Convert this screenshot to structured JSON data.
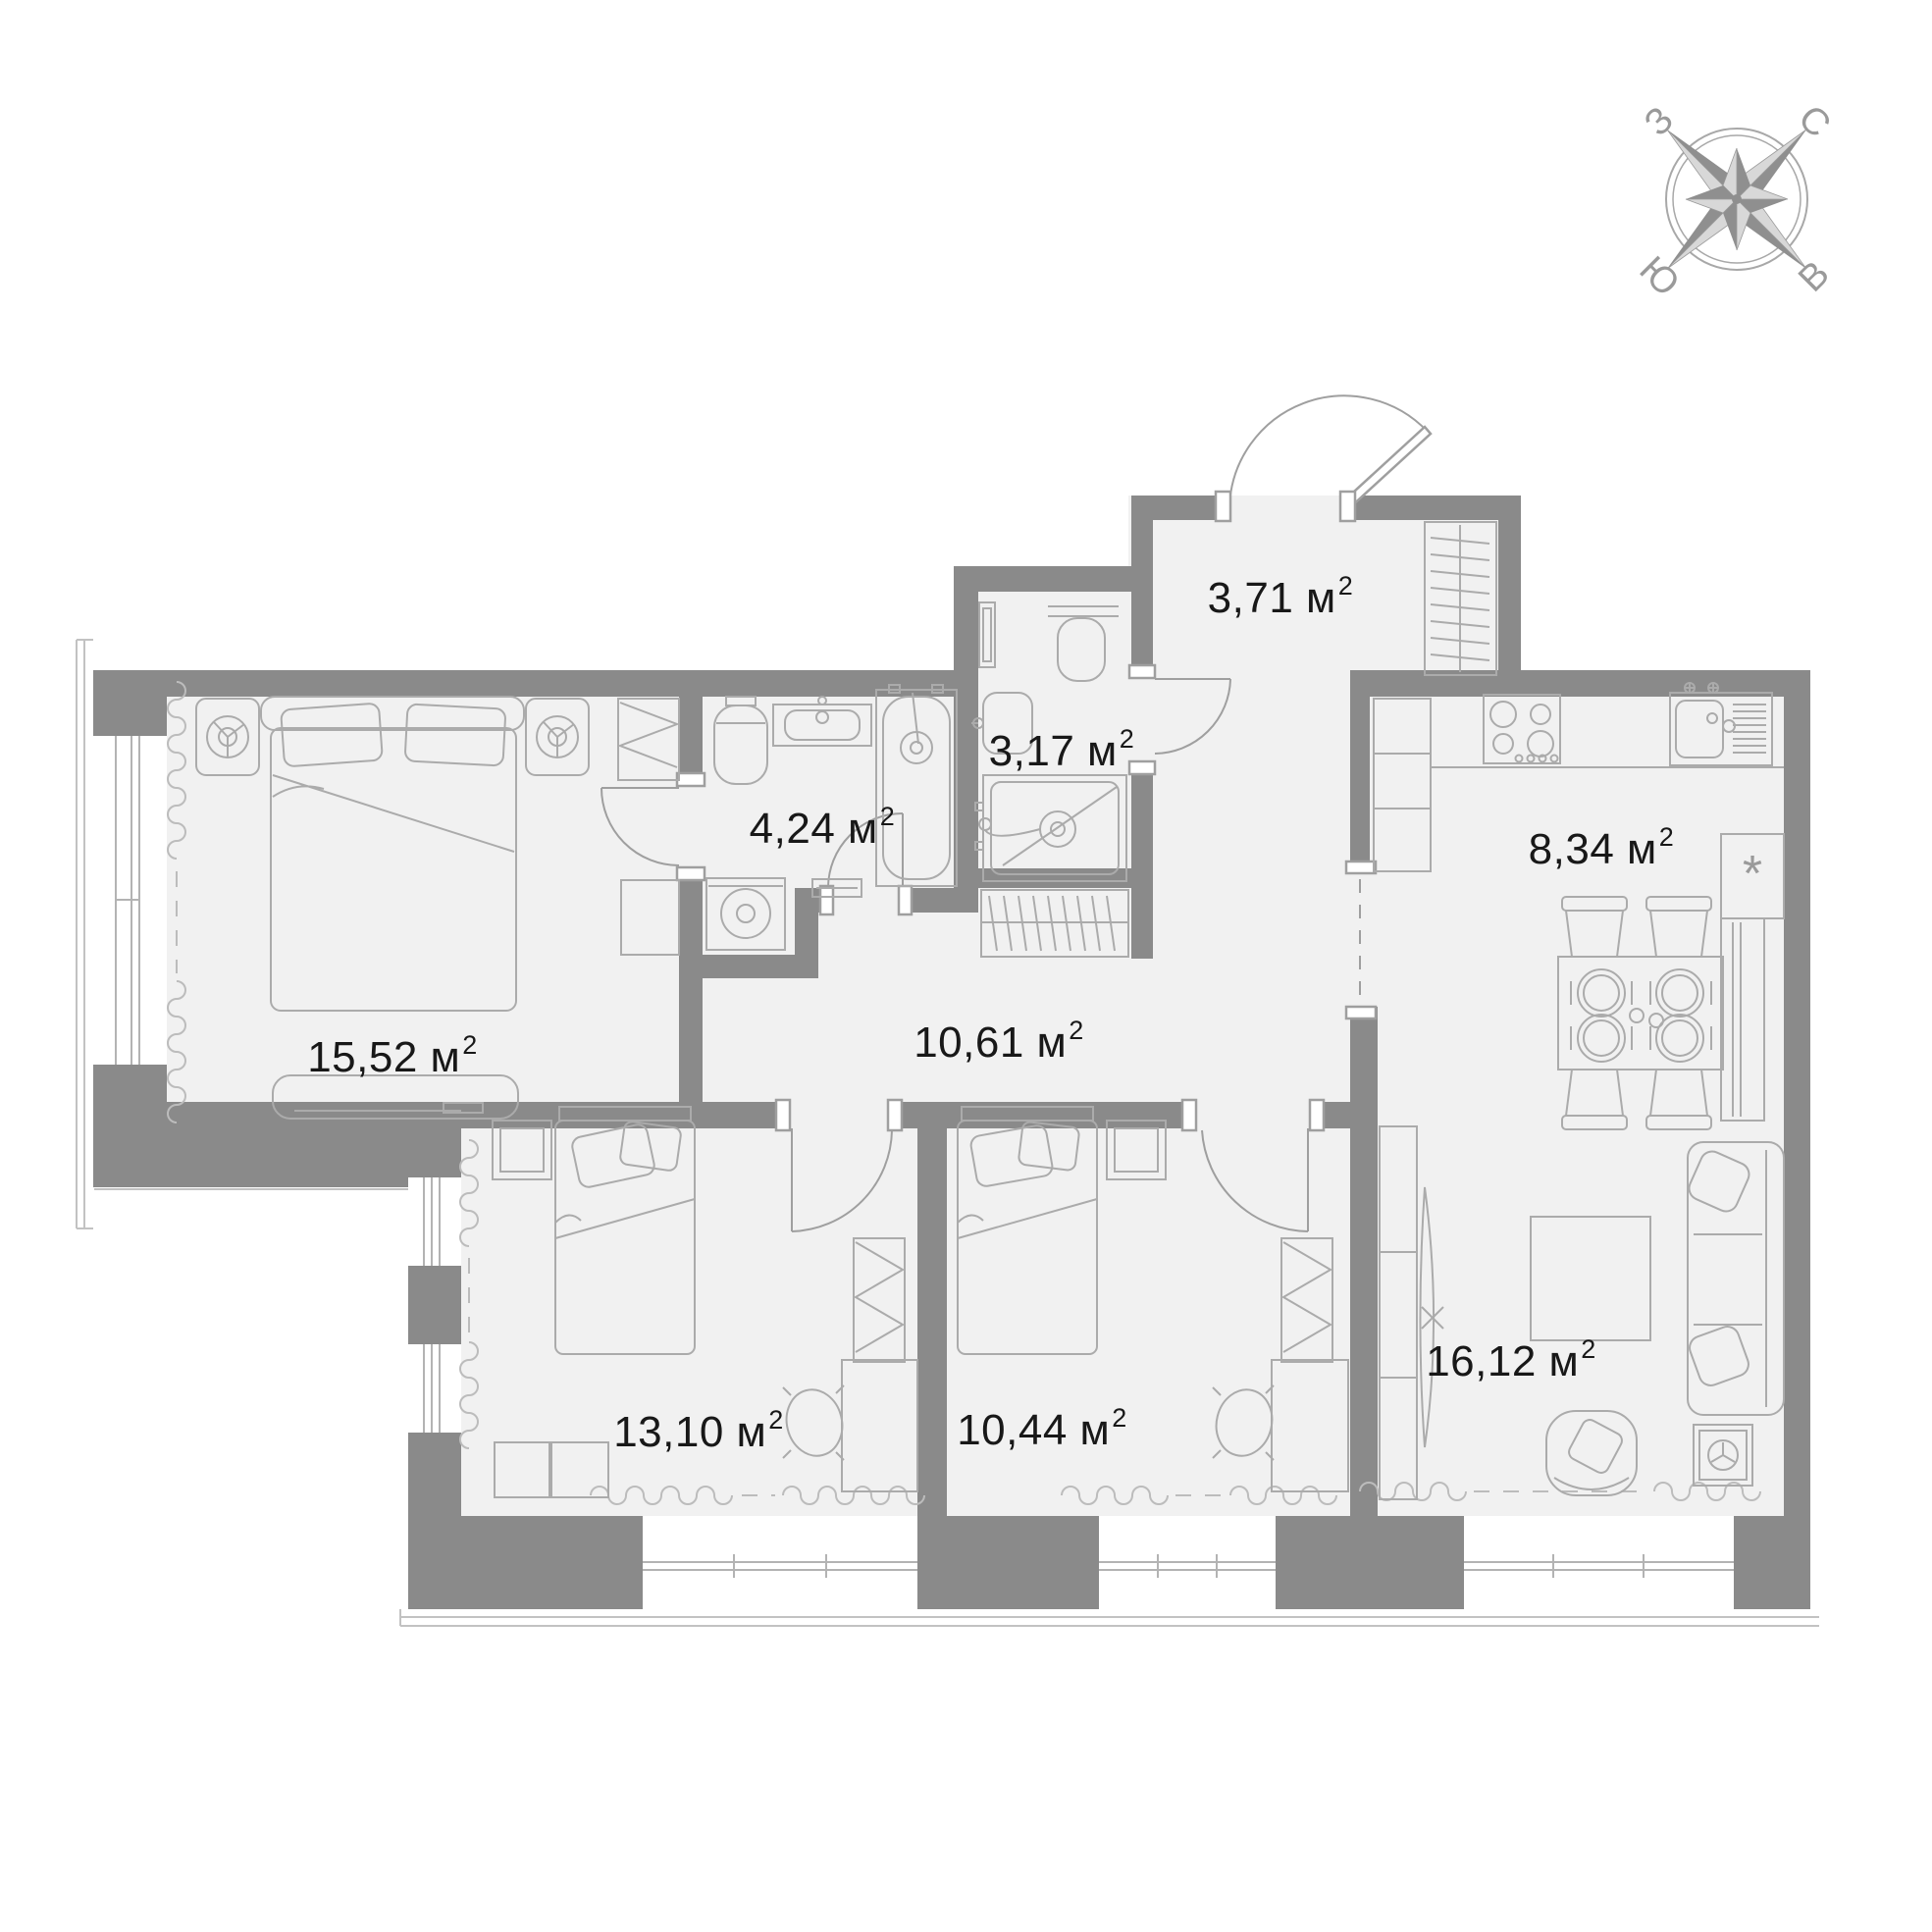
{
  "compass": {
    "north": "С",
    "east": "В",
    "south": "Ю",
    "west": "З"
  },
  "units": {
    "area": "м",
    "sup": "2"
  },
  "rooms": {
    "entrance_hall": {
      "area": "3,71"
    },
    "shower_room": {
      "area": "3,17"
    },
    "bathroom": {
      "area": "4,24"
    },
    "bedroom_main": {
      "area": "15,52"
    },
    "hallway": {
      "area": "10,61"
    },
    "kitchen": {
      "area": "8,34"
    },
    "living_room": {
      "area": "16,12"
    },
    "bedroom_2": {
      "area": "13,10"
    },
    "bedroom_3": {
      "area": "10,44"
    }
  },
  "markers": {
    "boiler": "*"
  }
}
